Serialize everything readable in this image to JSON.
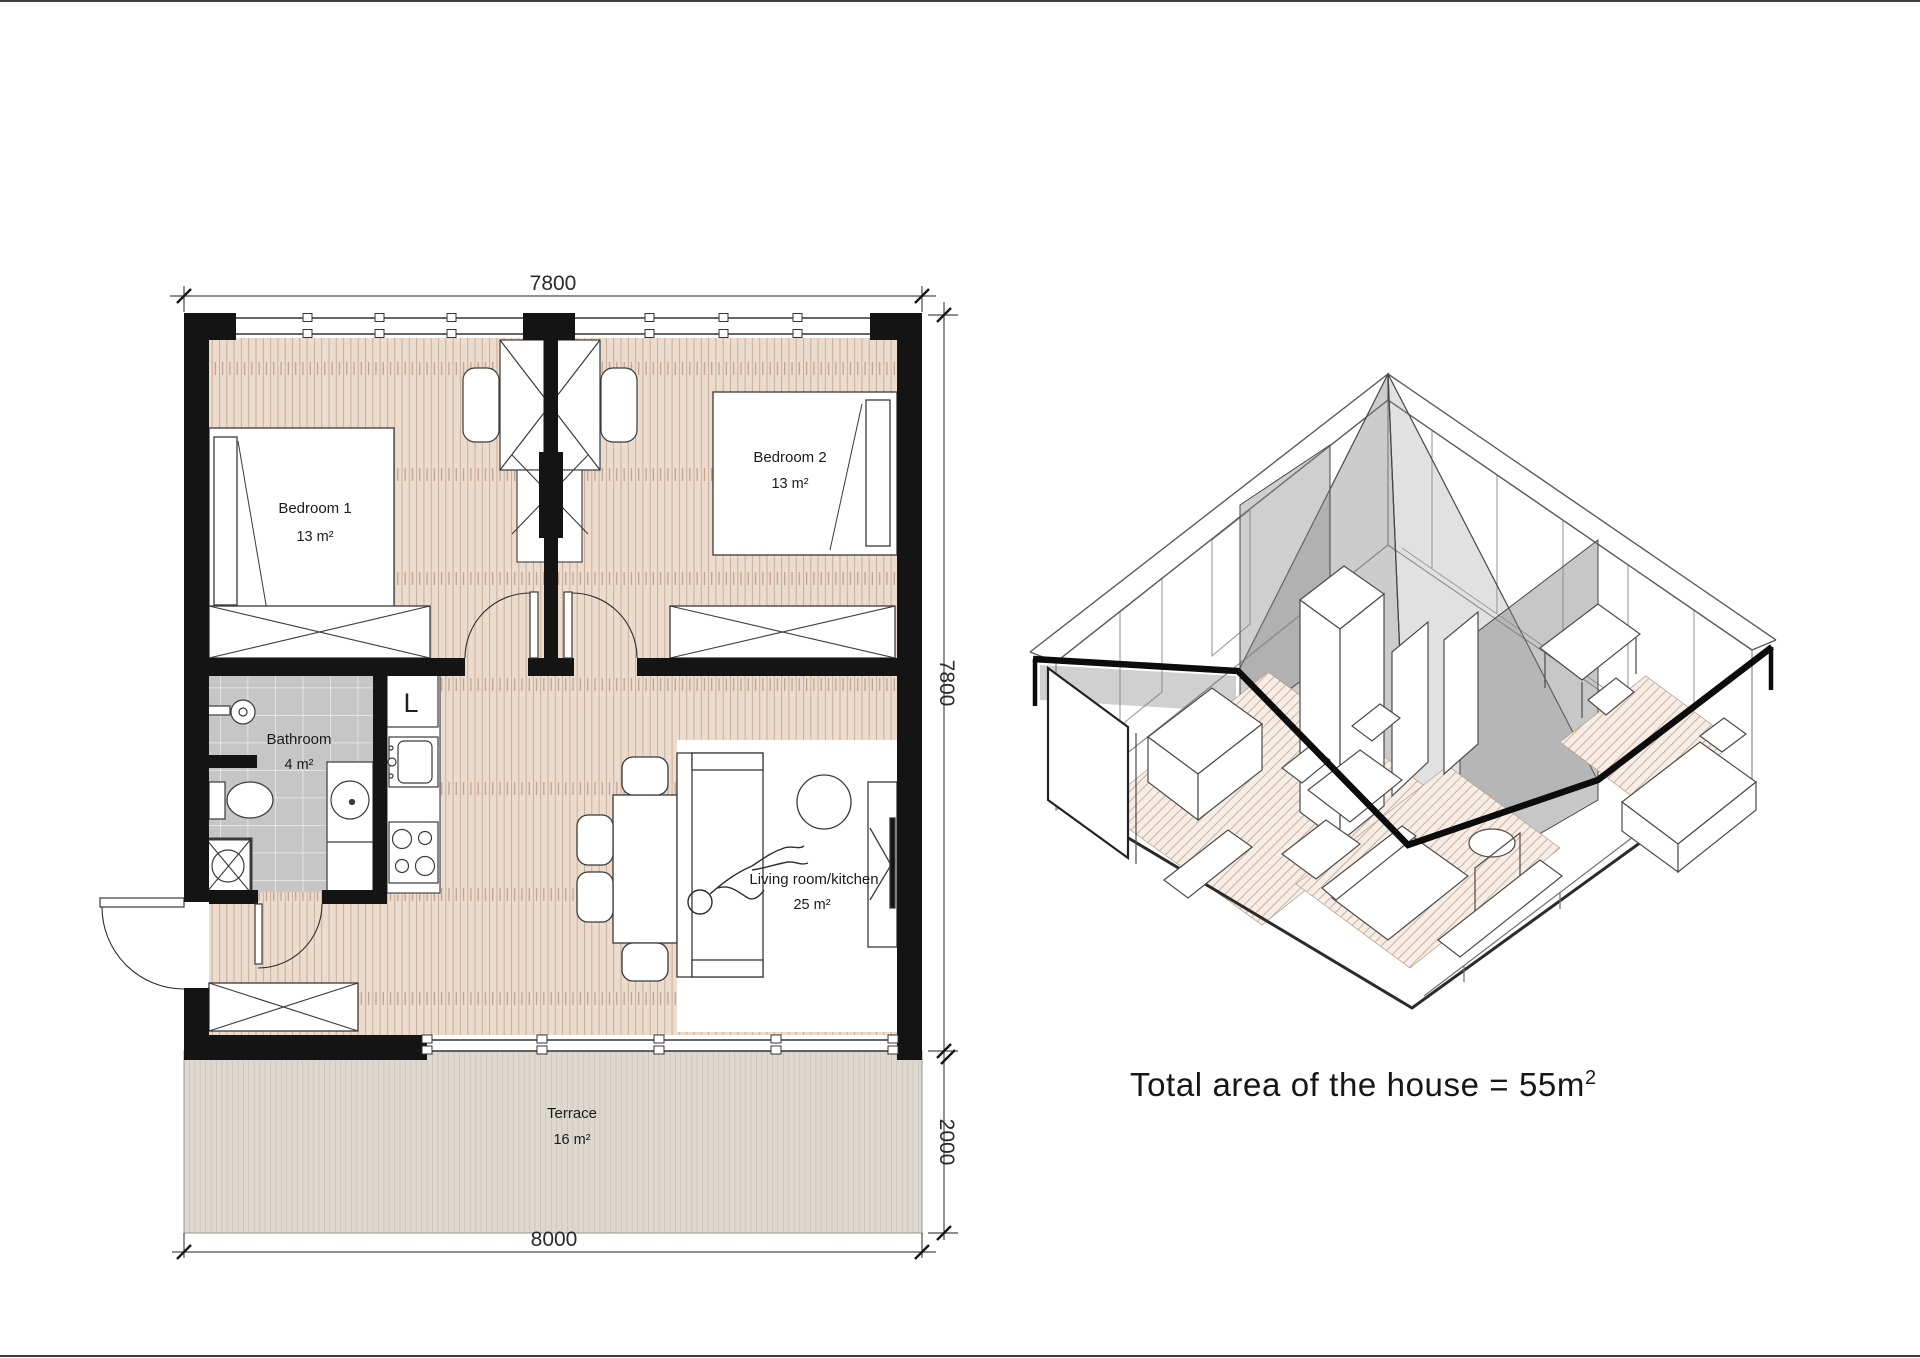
{
  "floor_plan": {
    "dimensions": {
      "top": "7800",
      "right_upper": "7800",
      "right_lower": "2000",
      "bottom": "8000"
    },
    "rooms": {
      "bedroom1": {
        "name": "Bedroom 1",
        "area": "13 m²"
      },
      "bedroom2": {
        "name": "Bedroom 2",
        "area": "13 m²"
      },
      "bathroom": {
        "name": "Bathroom",
        "area": "4 m²"
      },
      "living": {
        "name": "Living room/kitchen",
        "area": "25 m²"
      },
      "terrace": {
        "name": "Terrace",
        "area": "16 m²"
      }
    },
    "kitchen": {
      "fridge_label": "L"
    }
  },
  "iso_view": {
    "caption_text": "Total area of the house = 55m",
    "caption_superscript": "2"
  },
  "colors": {
    "wall": "#141414",
    "wood_floor": "#ecdccd",
    "wood_grain": "#cbae9a",
    "bathroom_tile": "#c6c6c6",
    "terrace_deck": "#ded9d0",
    "drawing_line": "#333333",
    "cut_section": "#0c0c0c",
    "iso_glass": "#8a8a8a"
  }
}
